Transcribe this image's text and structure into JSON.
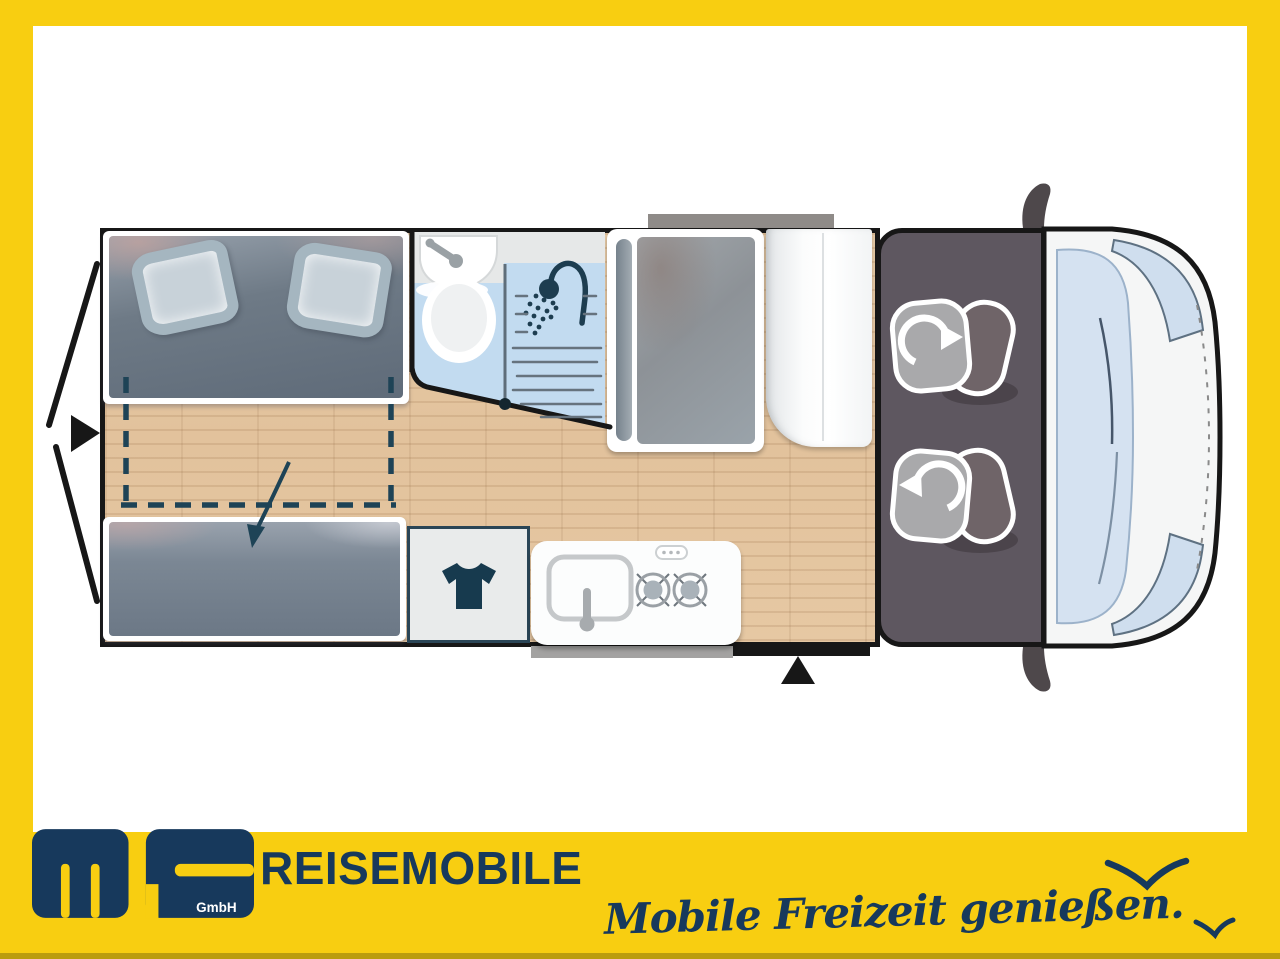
{
  "brand": {
    "logo": {
      "letters": "ms",
      "suffix": "GmbH"
    },
    "company": "REISEMOBILE",
    "tagline": "Mobile Freizeit genießen.",
    "colors": {
      "yellow": "#F8CE11",
      "navy": "#17395C",
      "icon_navy": "#1D3D50"
    }
  },
  "floorplan": {
    "subject": "camper-van-top-view",
    "icons": {
      "rear_door_arrow": "triangle-right",
      "bed_extension": "dashed-rectangle-with-curved-down-arrow",
      "washbasin": "sink-with-faucet",
      "toilet": "toilet-top-view",
      "shower": "shower-head-with-spray",
      "wardrobe": "t-shirt",
      "kitchen_hob": "two-gas-burners",
      "kitchen_sink": "sink-with-faucet",
      "seat_swivel": "rotate-arrow",
      "entry_door": "triangle-up",
      "birds": "seagull-strokes"
    }
  }
}
